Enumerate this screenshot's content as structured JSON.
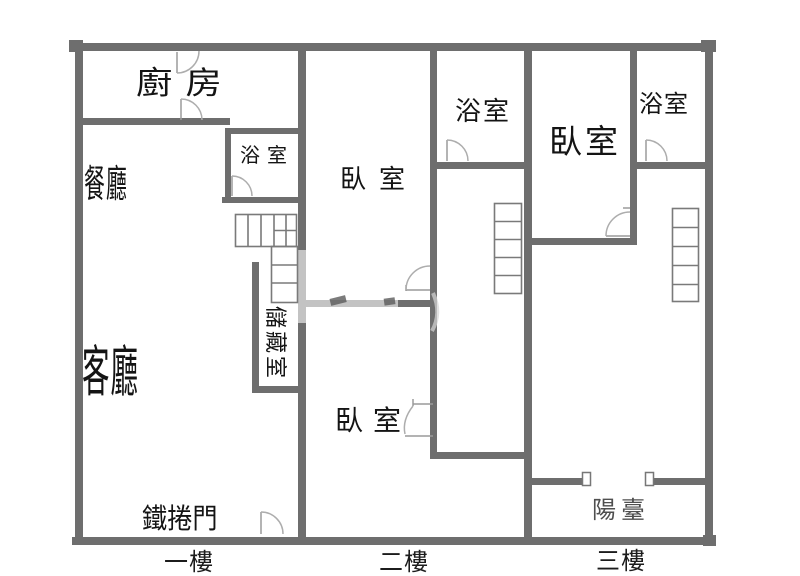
{
  "plan": {
    "colors": {
      "wall": "#6e6e6e",
      "wall_light": "#c3c3c3",
      "stair_line": "#7a7a7a",
      "door_line": "#adadad",
      "text": "#141414",
      "balcony_text": "#4f4f4f"
    },
    "floors": [
      {
        "label": "一樓",
        "rooms": {
          "kitchen": "廚房",
          "dining": "餐廳",
          "bathroom": "浴室",
          "living": "客廳",
          "storage": "儲藏室",
          "roller_door": "鐵捲門"
        }
      },
      {
        "label": "二樓",
        "rooms": {
          "bathroom": "浴室",
          "bedroom_upper": "臥室",
          "bedroom_lower": "臥室"
        }
      },
      {
        "label": "三樓",
        "rooms": {
          "bedroom": "臥室",
          "bathroom": "浴室",
          "balcony": "陽臺"
        }
      }
    ]
  }
}
